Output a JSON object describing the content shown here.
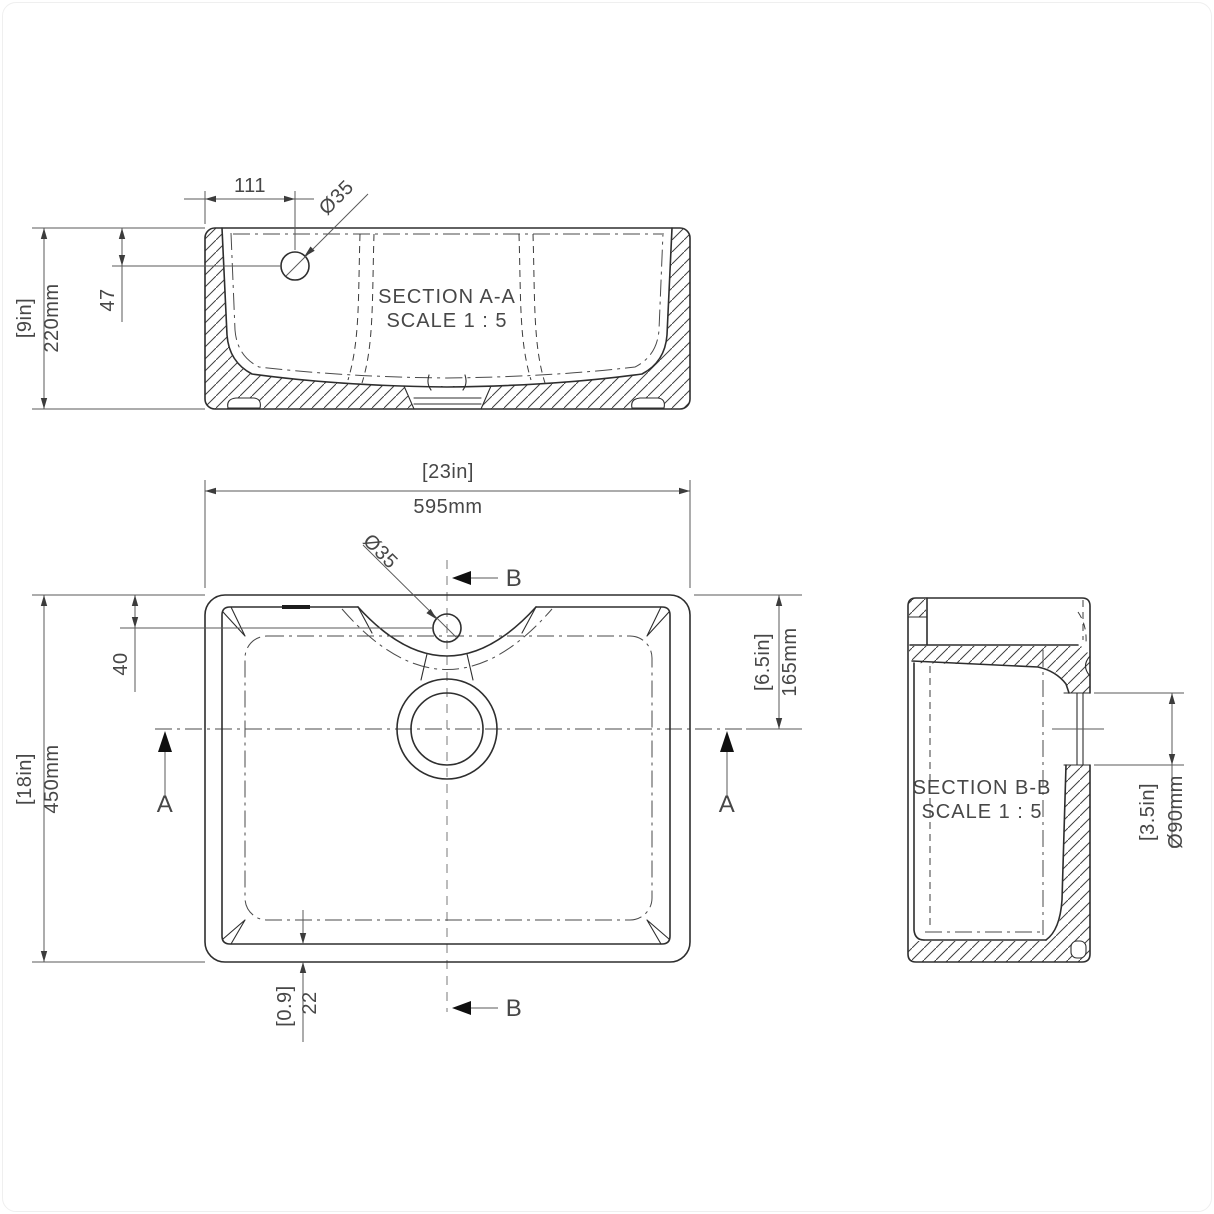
{
  "meta": {
    "background": "#ffffff",
    "line_color": "#2e2e2e",
    "text_color": "#474747"
  },
  "section_aa": {
    "title_line1": "SECTION A-A",
    "title_line2": "SCALE 1 : 5",
    "dims": {
      "hole_offset_width": "111",
      "hole_diameter": "Ø35",
      "hole_depth": "47",
      "height_in": "[9in]",
      "height_mm": "220mm"
    }
  },
  "plan": {
    "dims": {
      "width_in": "[23in]",
      "width_mm": "595mm",
      "hole_diameter": "Ø35",
      "hole_offset": "40",
      "height_in": "[18in]",
      "height_mm": "450mm",
      "drain_offset_in": "[6.5in]",
      "drain_offset_mm": "165mm",
      "wall_in": "[0.9]",
      "wall_mm": "22"
    },
    "section_marks": {
      "a": "A",
      "b": "B"
    }
  },
  "section_bb": {
    "title_line1": "SECTION B-B",
    "title_line2": "SCALE 1 : 5",
    "dims": {
      "drain_in": "[3.5in]",
      "drain_mm": "Ø90mm"
    }
  }
}
